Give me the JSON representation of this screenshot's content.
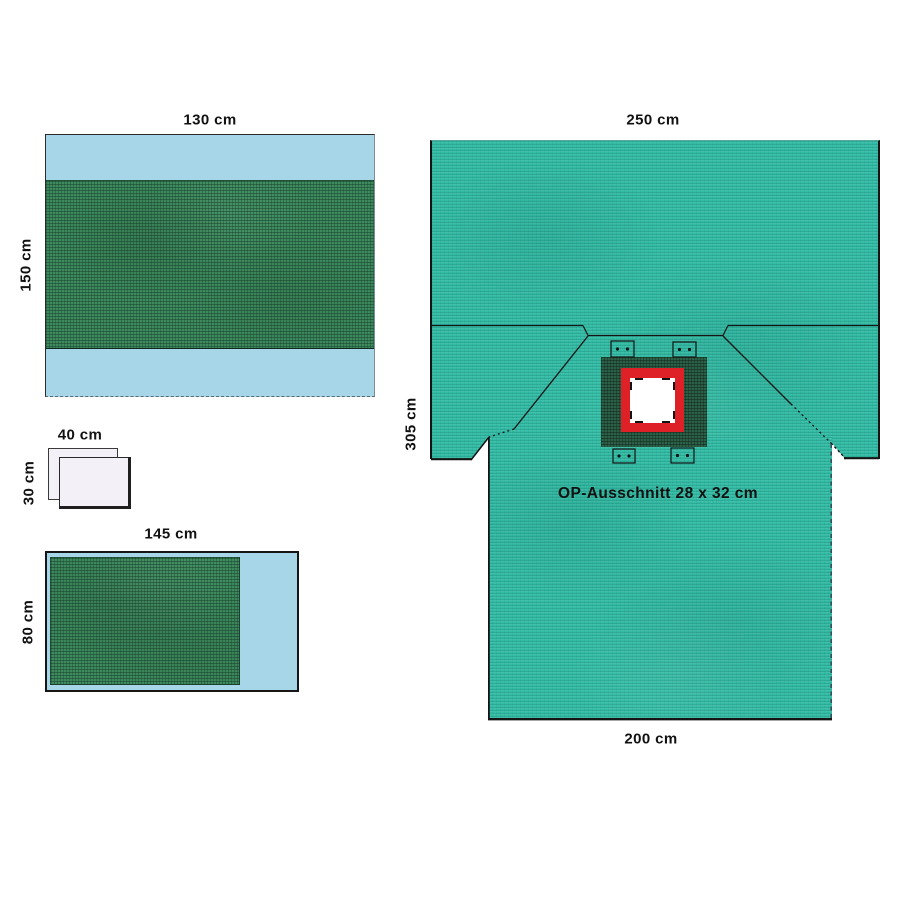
{
  "diagram": {
    "drape_top_left": {
      "width_label": "130 cm",
      "height_label": "150 cm"
    },
    "sheets": {
      "width_label": "40 cm",
      "height_label": "30 cm"
    },
    "drape_bottom_left": {
      "width_label": "145 cm",
      "height_label": "80 cm"
    },
    "main_drape": {
      "top_width_label": "250 cm",
      "height_label": "305 cm",
      "bottom_width_label": "200 cm",
      "aperture_label": "OP-Ausschnitt 28 x 32 cm"
    },
    "colors": {
      "light_blue": "#A7D6E8",
      "fabric_green": "#3E8A5E",
      "fabric_teal": "#34BCA5",
      "aperture_dark_green": "#2B5F46",
      "aperture_red": "#DE2027",
      "aperture_opening": "#FFFFFF",
      "sheet_white": "#F3F1F7",
      "line": "#141414"
    }
  }
}
